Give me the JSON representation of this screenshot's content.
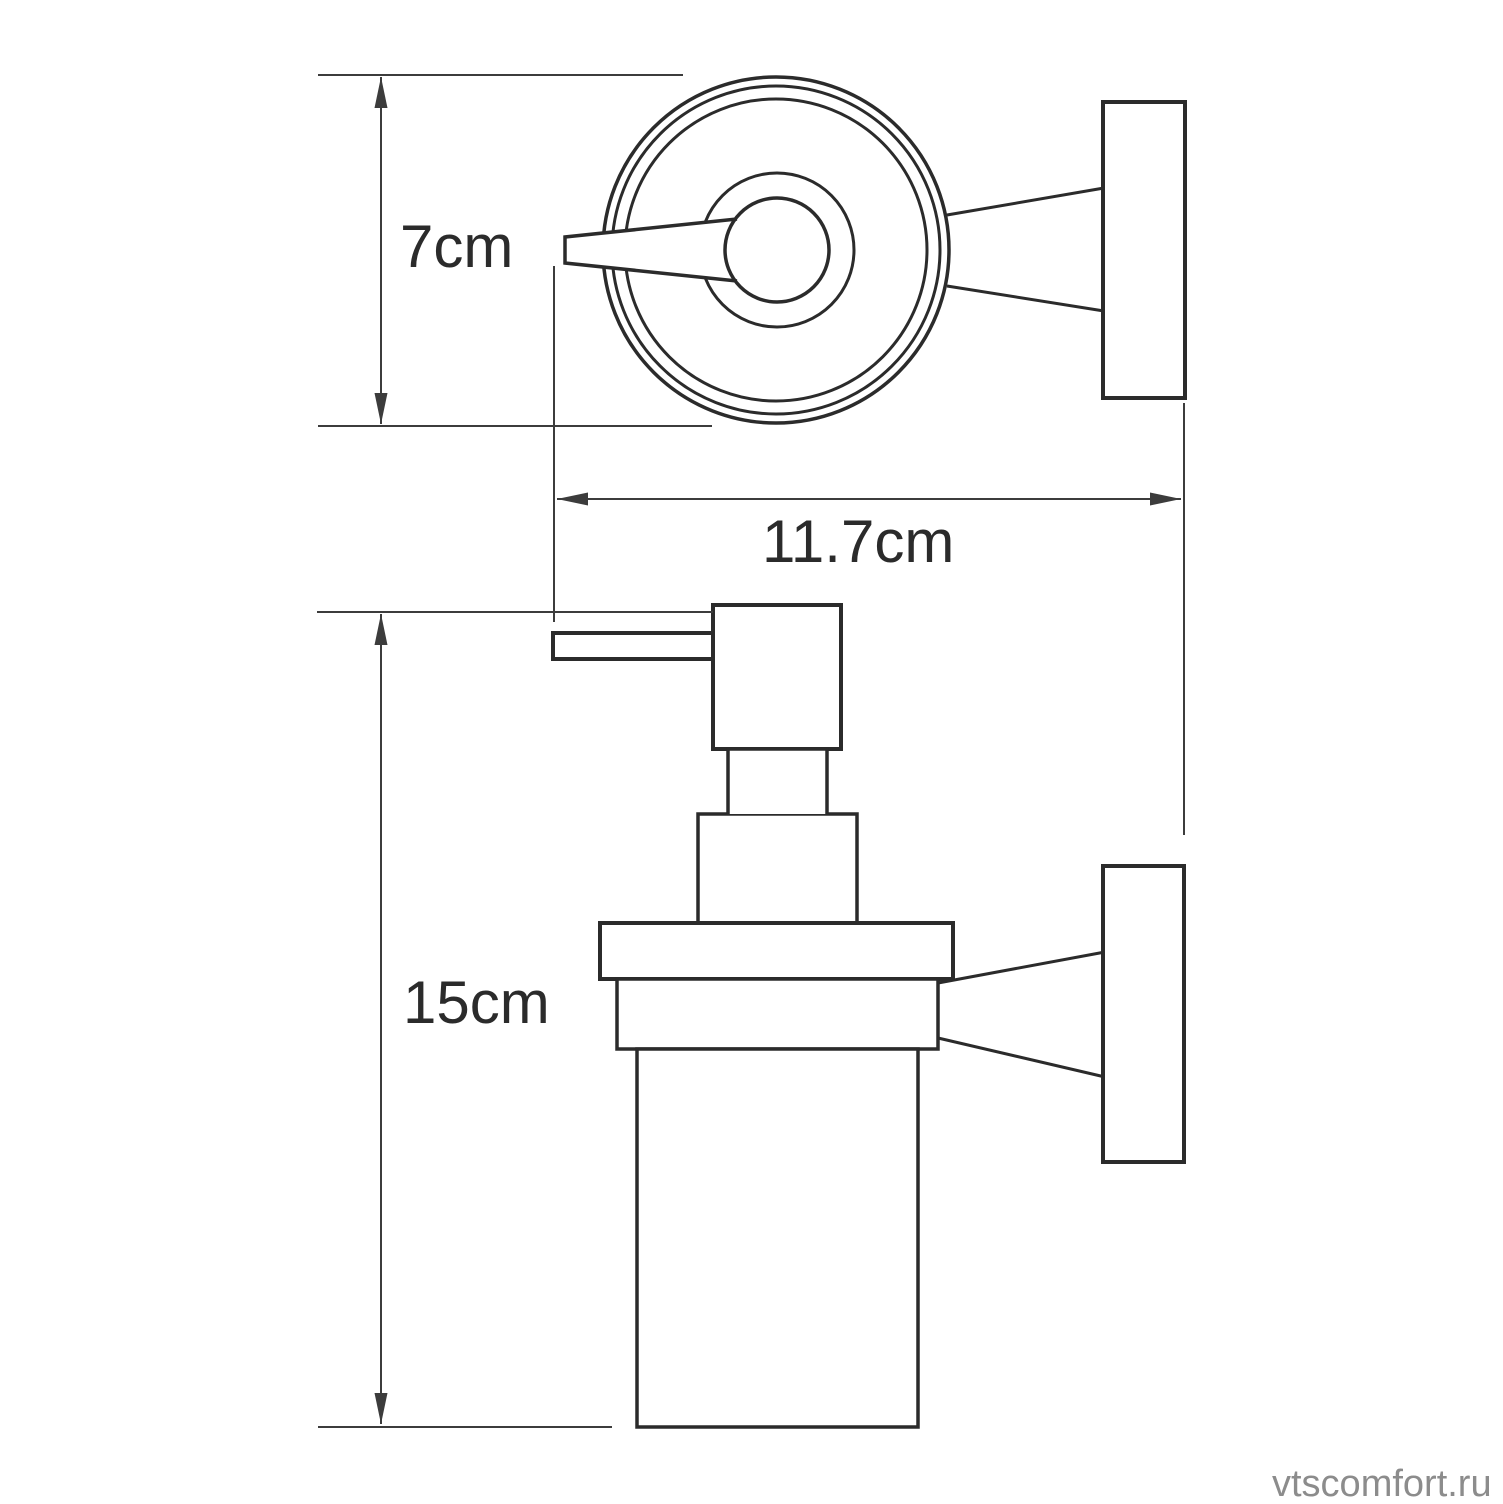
{
  "drawing": {
    "kind": "technical-dimension-drawing",
    "subject": "wall-mounted glass soap dispenser with holder (top view and front view)",
    "views": [
      "top-view",
      "front-view"
    ],
    "watermark": {
      "text": "vtscomfort.ru"
    },
    "dimensions": {
      "diameter_label": "7cm",
      "depth_label": "11.7cm",
      "height_label": "15cm"
    },
    "colors": {
      "outline": "#2b2b2b",
      "dimension_line": "#3c3c3c",
      "watermark": "#8c8c8c",
      "background": "#ffffff"
    }
  }
}
